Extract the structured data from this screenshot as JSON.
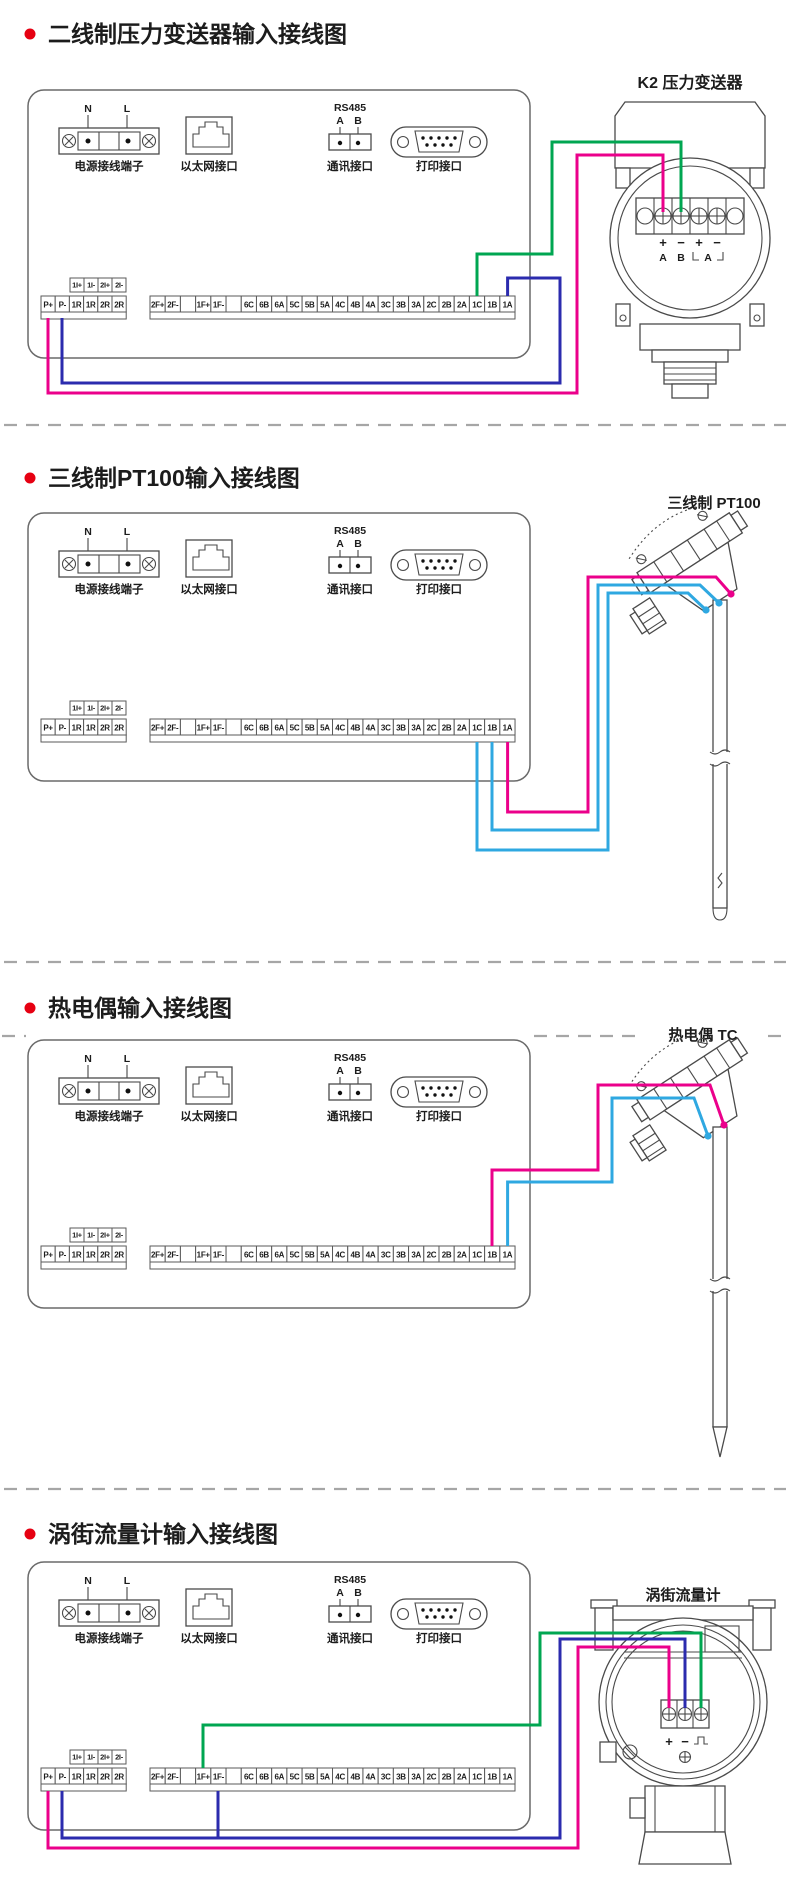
{
  "colors": {
    "pink": "#EB008B",
    "blue": "#2B2BAE",
    "green": "#00A651",
    "cyan": "#2FA8E1",
    "bullet": "#E60012"
  },
  "panel": {
    "power_n": "N",
    "power_l": "L",
    "power_label": "电源接线端子",
    "ethernet_label": "以太网接口",
    "rs485_title": "RS485",
    "rs485_a": "A",
    "rs485_b": "B",
    "comm_label": "通讯接口",
    "print_label": "打印接口"
  },
  "strip": {
    "upper": [
      "1I+",
      "1I-",
      "2I+",
      "2I-"
    ],
    "left": [
      "P+",
      "P-",
      "1R",
      "1R",
      "2R",
      "2R"
    ],
    "right": [
      "2F+",
      "2F-",
      "",
      "1F+",
      "1F-",
      "",
      "6C",
      "6B",
      "6A",
      "5C",
      "5B",
      "5A",
      "4C",
      "4B",
      "4A",
      "3C",
      "3B",
      "3A",
      "2C",
      "2B",
      "2A",
      "1C",
      "1B",
      "1A"
    ]
  },
  "sections": [
    {
      "title": "二线制压力变送器输入接线图",
      "device": "K2  压力变送器",
      "signs": [
        "+",
        "−",
        "+",
        "−"
      ],
      "row2": [
        "A",
        "B",
        "A"
      ]
    },
    {
      "title": "三线制PT100输入接线图",
      "device": "三线制  PT100"
    },
    {
      "title": "热电偶输入接线图",
      "device": "热电偶  TC"
    },
    {
      "title": "涡街流量计输入接线图",
      "device": "涡街流量计",
      "signs": [
        "+",
        "−"
      ]
    }
  ]
}
